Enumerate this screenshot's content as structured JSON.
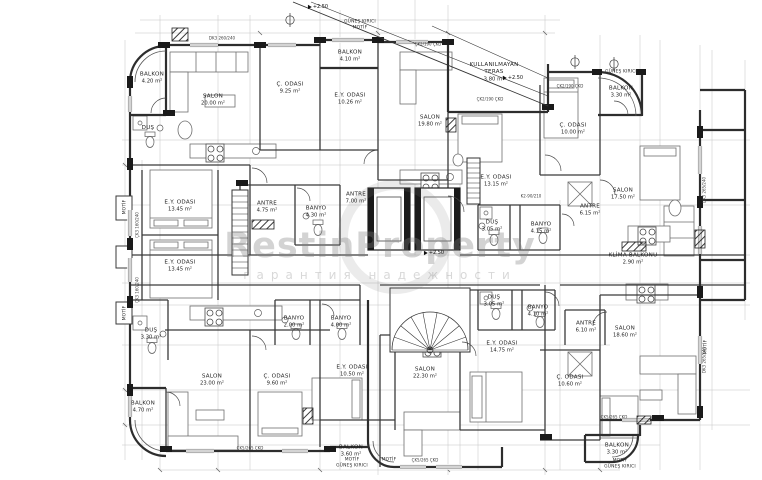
{
  "watermark": {
    "brand": "RestinProperty",
    "subtitle": "гарантия надежности"
  },
  "colors": {
    "paper": "#ffffff",
    "wall": "#2d2d2d",
    "hairline": "#bdbdbd",
    "watermark": "#7d7d7d"
  },
  "rooms": [
    {
      "name": "balkon-top-left",
      "label": "BALKON",
      "area": "4.20 m²",
      "x": 152,
      "y": 78
    },
    {
      "name": "salon-top-left",
      "label": "SALON",
      "area": "20.00 m²",
      "x": 213,
      "y": 100
    },
    {
      "name": "dus-top-left",
      "label": "DUŞ",
      "area": "",
      "x": 148,
      "y": 128
    },
    {
      "name": "c-odasi-top-left",
      "label": "Ç. ODASI",
      "area": "9.25 m²",
      "x": 290,
      "y": 88
    },
    {
      "name": "balkon-top-mid",
      "label": "BALKON",
      "area": "4.10 m²",
      "x": 350,
      "y": 56
    },
    {
      "name": "ey-odasi-top-mid",
      "label": "E.Y. ODASI",
      "area": "10.26 m²",
      "x": 350,
      "y": 99
    },
    {
      "name": "salon-top-mid",
      "label": "SALON",
      "area": "19.80 m²",
      "x": 430,
      "y": 121
    },
    {
      "name": "kullanilmayan-teras",
      "label": "KULLANILMAYAN TERAS",
      "area": "3.80 m²",
      "x": 494,
      "y": 72
    },
    {
      "name": "c-odasi-top-right",
      "label": "Ç. ODASI",
      "area": "10.00 m²",
      "x": 573,
      "y": 129
    },
    {
      "name": "balkon-top-right",
      "label": "BALKON",
      "area": "3.30 m²",
      "x": 621,
      "y": 92
    },
    {
      "name": "salon-top-right",
      "label": "SALON",
      "area": "17.50 m²",
      "x": 623,
      "y": 194
    },
    {
      "name": "ey-odasi-center",
      "label": "E.Y. ODASI",
      "area": "13.15 m²",
      "x": 496,
      "y": 181
    },
    {
      "name": "ey-odasi-left-1",
      "label": "E.Y. ODASI",
      "area": "13.45 m²",
      "x": 180,
      "y": 206
    },
    {
      "name": "ey-odasi-left-2",
      "label": "E.Y. ODASI",
      "area": "13.45 m²",
      "x": 180,
      "y": 266
    },
    {
      "name": "antre-left",
      "label": "ANTRE",
      "area": "4.75 m²",
      "x": 267,
      "y": 207
    },
    {
      "name": "banyo-left",
      "label": "BANYO",
      "area": "4.30 m²",
      "x": 316,
      "y": 212
    },
    {
      "name": "antre-center",
      "label": "ANTRE",
      "area": "7.00 m²",
      "x": 356,
      "y": 198
    },
    {
      "name": "dus-center",
      "label": "DUŞ",
      "area": "3.05 m²",
      "x": 492,
      "y": 226
    },
    {
      "name": "banyo-center",
      "label": "BANYO",
      "area": "4.15 m²",
      "x": 541,
      "y": 228
    },
    {
      "name": "antre-top-right",
      "label": "ANTRE",
      "area": "6.15 m²",
      "x": 590,
      "y": 210
    },
    {
      "name": "klima-balkonu",
      "label": "KLİMA BALKONU",
      "area": "2.90 m²",
      "x": 633,
      "y": 259
    },
    {
      "name": "dus-bottom-left",
      "label": "DUŞ",
      "area": "3.30 m²",
      "x": 151,
      "y": 334
    },
    {
      "name": "banyo-bottom-left-1",
      "label": "BANYO",
      "area": "2.00 m²",
      "x": 294,
      "y": 322
    },
    {
      "name": "banyo-bottom-left-2",
      "label": "BANYO",
      "area": "4.00 m²",
      "x": 341,
      "y": 322
    },
    {
      "name": "salon-bottom-left",
      "label": "SALON",
      "area": "23.00 m²",
      "x": 212,
      "y": 380
    },
    {
      "name": "c-odasi-bottom-left",
      "label": "Ç. ODASI",
      "area": "9.60 m²",
      "x": 277,
      "y": 380
    },
    {
      "name": "ey-odasi-bottom-left",
      "label": "E.Y. ODASI",
      "area": "10.50 m²",
      "x": 352,
      "y": 371
    },
    {
      "name": "balkon-bottom-left",
      "label": "BALKON",
      "area": "4.70 m²",
      "x": 143,
      "y": 407
    },
    {
      "name": "balkon-bottom-mid",
      "label": "BALKON",
      "area": "3.60 m²",
      "x": 351,
      "y": 451
    },
    {
      "name": "dus-bottom-mid",
      "label": "DUŞ",
      "area": "3.05 m²",
      "x": 494,
      "y": 301
    },
    {
      "name": "banyo-bottom-mid",
      "label": "BANYO",
      "area": "4.10 m²",
      "x": 538,
      "y": 311
    },
    {
      "name": "ey-odasi-bottom-mid",
      "label": "E.Y. ODASI",
      "area": "14.75 m²",
      "x": 502,
      "y": 347
    },
    {
      "name": "salon-bottom-mid",
      "label": "SALON",
      "area": "22.30 m²",
      "x": 425,
      "y": 373
    },
    {
      "name": "antre-bottom-right",
      "label": "ANTRE",
      "area": "6.10 m²",
      "x": 586,
      "y": 327
    },
    {
      "name": "salon-bottom-right",
      "label": "SALON",
      "area": "18.60 m²",
      "x": 625,
      "y": 332
    },
    {
      "name": "c-odasi-bottom-right",
      "label": "Ç. ODASI",
      "area": "10.60 m²",
      "x": 570,
      "y": 381
    },
    {
      "name": "balkon-bottom-right",
      "label": "BALKON",
      "area": "3.30 m²",
      "x": 617,
      "y": 449
    }
  ],
  "notes": [
    {
      "text": "GÜNEŞ KIRICI",
      "x": 360,
      "y": 21,
      "rot": 0
    },
    {
      "text": "MOTİF",
      "x": 360,
      "y": 27,
      "rot": 0
    },
    {
      "text": "GÜNEŞ KIRICI",
      "x": 621,
      "y": 71,
      "rot": 0
    },
    {
      "text": "MOTİF",
      "x": 352,
      "y": 459,
      "rot": 0
    },
    {
      "text": "GÜNEŞ KIRICI",
      "x": 352,
      "y": 465,
      "rot": 0
    },
    {
      "text": "MOTİF",
      "x": 620,
      "y": 460,
      "rot": 0
    },
    {
      "text": "GÜNEŞ KIRICI",
      "x": 620,
      "y": 466,
      "rot": 0
    },
    {
      "text": "MOTİF",
      "x": 124,
      "y": 207,
      "rot": 90
    },
    {
      "text": "MOTİF",
      "x": 124,
      "y": 313,
      "rot": 90
    },
    {
      "text": "MOTİF",
      "x": 705,
      "y": 347,
      "rot": 90
    },
    {
      "text": "MOTİF",
      "x": 389,
      "y": 459,
      "rot": 0
    }
  ],
  "levels": [
    {
      "text": "+2.50",
      "x": 318,
      "y": 7
    },
    {
      "text": "+2.50",
      "x": 513,
      "y": 78
    },
    {
      "text": "+2.50",
      "x": 434,
      "y": 253
    }
  ],
  "wall_tags": [
    {
      "text": "DK3 260/240",
      "x": 222,
      "y": 38,
      "rot": 0
    },
    {
      "text": "ÇK2/190 ÇKD",
      "x": 428,
      "y": 44,
      "rot": 0
    },
    {
      "text": "ÇK2/190 ÇKD",
      "x": 490,
      "y": 99,
      "rot": 0
    },
    {
      "text": "ÇK2/190 ÇKD",
      "x": 570,
      "y": 86,
      "rot": 0
    },
    {
      "text": "K2-90/210",
      "x": 531,
      "y": 196,
      "rot": 0
    },
    {
      "text": "ÇK5/265 ÇKD",
      "x": 614,
      "y": 417,
      "rot": 0
    },
    {
      "text": "ÇK5/265 ÇKD",
      "x": 425,
      "y": 460,
      "rot": 0
    },
    {
      "text": "ÇK5/265 ÇKD",
      "x": 250,
      "y": 448,
      "rot": 0
    },
    {
      "text": "ÇK3 160/240",
      "x": 137,
      "y": 225,
      "rot": 90
    },
    {
      "text": "ÇK3 160/240",
      "x": 137,
      "y": 290,
      "rot": 90
    },
    {
      "text": "DK3 265/240",
      "x": 704,
      "y": 190,
      "rot": 90
    },
    {
      "text": "DK3 265/240",
      "x": 704,
      "y": 360,
      "rot": 90
    }
  ]
}
